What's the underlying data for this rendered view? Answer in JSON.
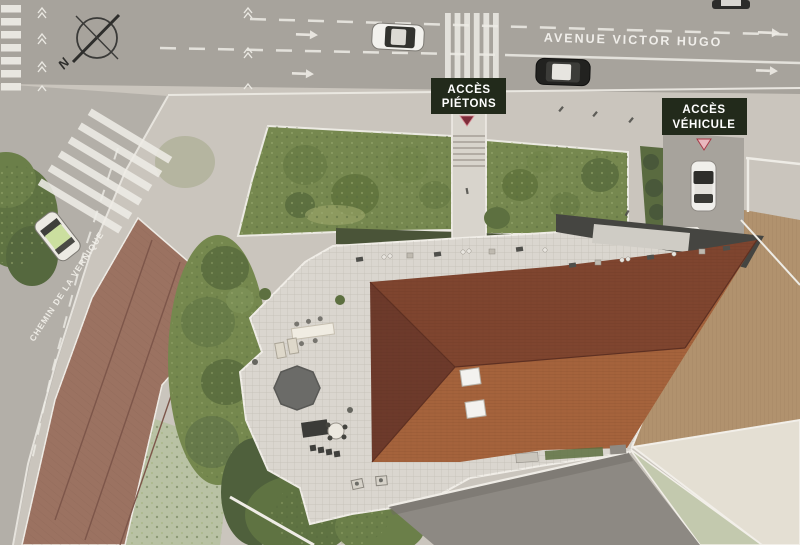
{
  "scene": {
    "compass": {
      "north_letter": "N"
    },
    "streets": [
      {
        "id": "avenue-victor-hugo",
        "name": "AVENUE VICTOR HUGO"
      },
      {
        "id": "chemin-de-la-vernique",
        "name": "CHEMIN DE LA VERNIQUE"
      }
    ],
    "access_labels": [
      {
        "id": "acces-pietons",
        "line1": "ACCÈS",
        "line2": "PIÉTONS"
      },
      {
        "id": "acces-vehicule",
        "line1": "ACCÈS",
        "line2": "VÉHICULE"
      }
    ],
    "vehicles": [
      {
        "id": "car-avenue-white"
      },
      {
        "id": "car-avenue-dark"
      },
      {
        "id": "car-avenue-partial"
      },
      {
        "id": "car-driveway-white"
      },
      {
        "id": "car-chemin-green"
      }
    ],
    "colors": {
      "sidewalk": "#cac5bd",
      "road": "#a7a39c",
      "road_left": "#b3afa8",
      "marking": "#eeece6",
      "label_box": "#222a1b",
      "label_text": "#ffffff",
      "marker_pietons": "#7e2d3a",
      "marker_vehicule": "#e9b8be",
      "marker_vehicule_border": "#a93a47",
      "terrace": "#dad6cf",
      "ramp": "#8d8983",
      "roof_top": "#7f452f",
      "roof_bottom": "#a5633c",
      "roof_left": "#6d3a2b",
      "flat_roof": "#454541",
      "existing_roof": "#9b7261",
      "neighbor_tan": "#b1926e",
      "neighbor_cream": "#e4dfd3",
      "neighbor_green": "#c3c9ae",
      "courtyard_green": "#b9c2a4",
      "garden": "#76884f",
      "hedge": "#4a5438",
      "canopy": "#6b6b68"
    }
  }
}
